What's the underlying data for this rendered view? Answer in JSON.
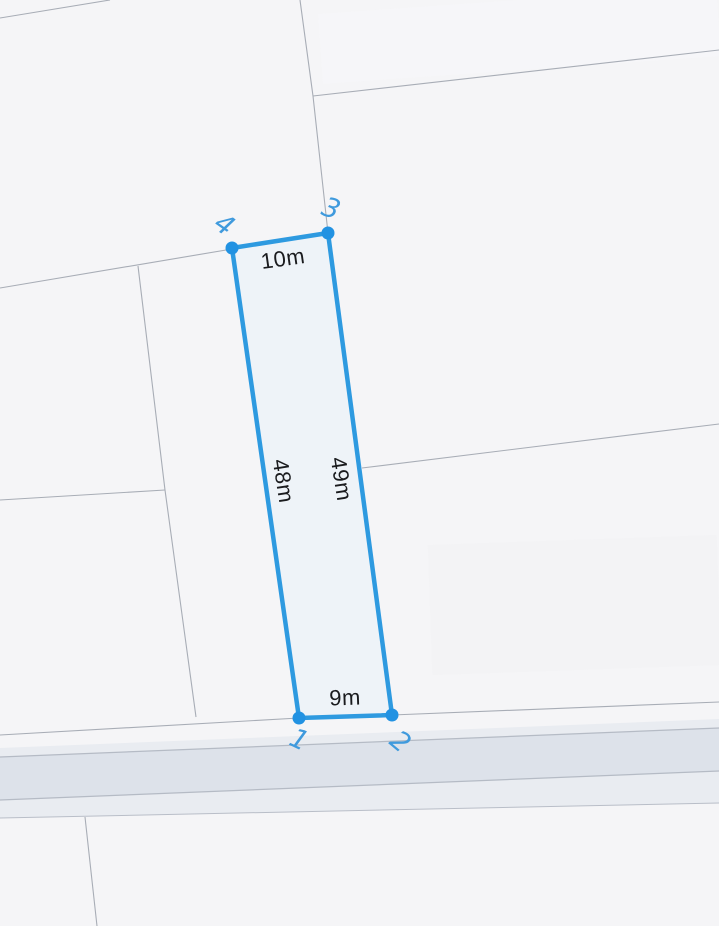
{
  "map": {
    "background_color": "#f5f5f7",
    "boundary_line_color": "#a8adb6",
    "road": {
      "shoulder_color": "#e9ecf1",
      "surface_color": "#dde2ea",
      "casing_color": "#b5bbc5"
    },
    "parcel": {
      "fill_color": "#edf2f8",
      "stroke_color": "#2e9ae0",
      "vertex_color": "#2292e2",
      "vertex_label_color": "#3f9add",
      "dimension_text_color": "#1a1b1e",
      "dimensions": {
        "top": "10m",
        "right": "49m",
        "bottom": "9m",
        "left": "48m"
      },
      "vertex_labels": {
        "v1": "1",
        "v2": "2",
        "v3": "3",
        "v4": "4"
      }
    }
  }
}
